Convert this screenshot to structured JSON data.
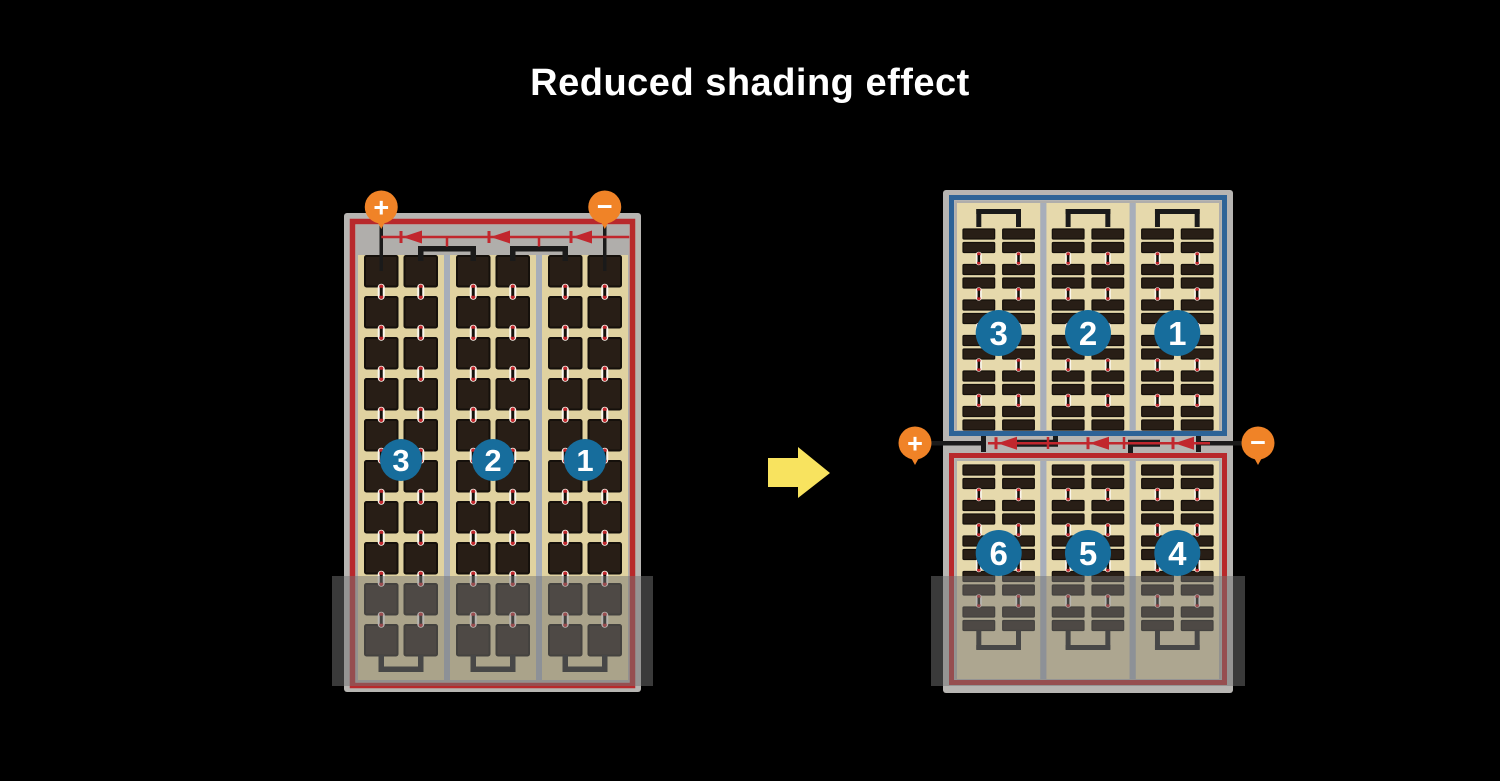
{
  "title": {
    "text": "Reduced shading effect",
    "color": "#ffffff"
  },
  "flow_arrow": {
    "direction": "right"
  },
  "left_module": {
    "name": "full-cell module",
    "terminals": {
      "positive": "+",
      "negative": "−"
    },
    "cell_strings": [
      {
        "label": "3"
      },
      {
        "label": "2"
      },
      {
        "label": "1"
      }
    ],
    "grid": {
      "strings": 3,
      "columns_per_string": 2,
      "cell_rows": 10
    },
    "bypass_diodes": 3,
    "shaded_bottom": true
  },
  "right_module": {
    "name": "half-cut module",
    "terminals": {
      "positive": "+",
      "negative": "−"
    },
    "top_cell_strings": [
      {
        "label": "3"
      },
      {
        "label": "2"
      },
      {
        "label": "1"
      }
    ],
    "bottom_cell_strings": [
      {
        "label": "6"
      },
      {
        "label": "5"
      },
      {
        "label": "4"
      }
    ],
    "grid": {
      "strings": 3,
      "columns_per_string": 2,
      "bar_rows_top": 12,
      "bar_rows_bottom": 10
    },
    "bypass_diodes": 3,
    "shaded_bottom": true
  },
  "colors": {
    "background": "#000000",
    "frame_gray": "#b7b5b2",
    "inner_gray": "#b0aeab",
    "tan_left": "#e0d2a0",
    "tan_right": "#e6d9ac",
    "cell_dark": "#281e16",
    "cell_border": "#15100b",
    "divider": "#a7aeba",
    "red_border": "#b8292c",
    "diode_red": "#c1272d",
    "blue_border": "#2d6397",
    "string_badge_blue": "#176d9c",
    "terminal_orange": "#f08327",
    "wire_black": "#1a1a1a",
    "arrow_yellow": "#f8e35f",
    "shade": "rgba(115,115,115,0.5)"
  }
}
